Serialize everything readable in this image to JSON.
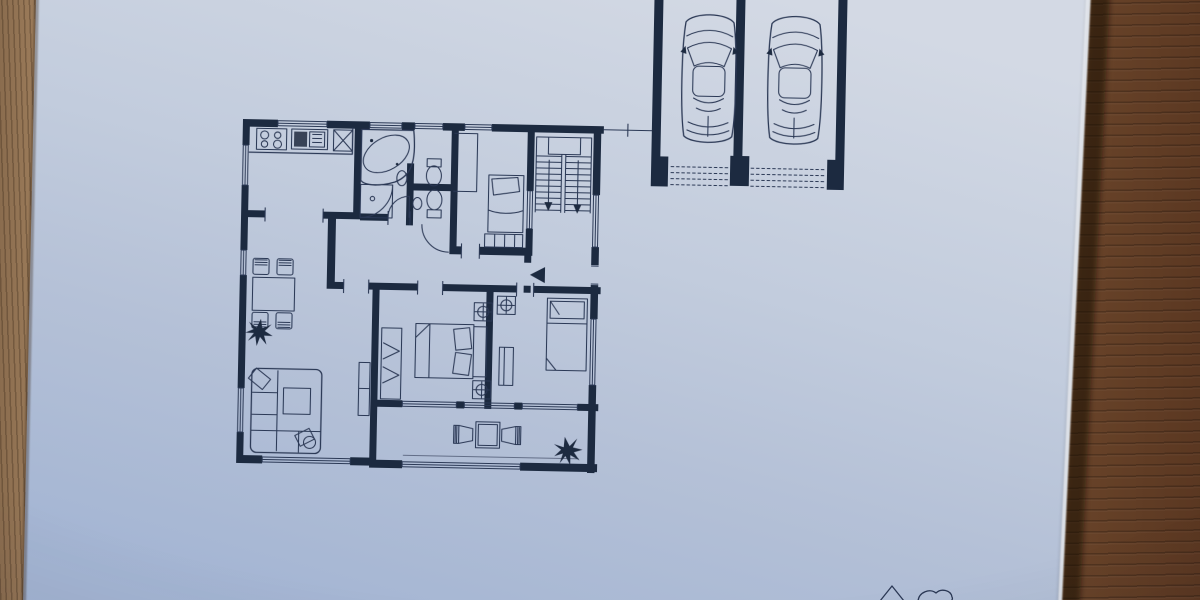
{
  "scene": {
    "description": "Photograph of a blueprint-style architectural floor plan drawn in dark ink on light blue paper, lying slightly tilted on a two-tone wooden table",
    "paper_tilt_deg": 1.15,
    "rooms": [
      "kitchen",
      "bathroom",
      "wc",
      "small-bedroom",
      "stairwell",
      "hall",
      "entrance-corridor",
      "living-dining-room",
      "master-bedroom",
      "second-bedroom",
      "balcony-terrace",
      "double-garage"
    ],
    "fixtures": [
      "stove-4-burner",
      "kitchen-sink",
      "kitchen-cabinet",
      "corner-bathtub",
      "shower",
      "wash-basin",
      "toilet",
      "dining-table",
      "dining-chair",
      "potted-plant",
      "corner-sofa",
      "coffee-table",
      "living-cabinet",
      "wardrobe",
      "double-bed",
      "nightstand-with-lamp",
      "single-bed",
      "desk",
      "closet",
      "balcony-table",
      "balcony-chair",
      "u-shaped-staircase",
      "entrance-direction-arrow",
      "car-top-view",
      "garage-door-hatching"
    ],
    "counts": {
      "garage_bays": 2,
      "cars": 2,
      "stair_flights": 2,
      "dining_chairs": 4,
      "balcony_chairs": 2,
      "plants": 2,
      "beds": 3,
      "toilets": 2,
      "nightstands_with_lamp": 3
    }
  },
  "colors": {
    "paper_light": "#d3d9e4",
    "paper_mid": "#bcc8db",
    "paper_deep": "#a4b5d3",
    "ink": "#1e2941",
    "line": "#2c3854",
    "wood_left_a": "#8a6c4e",
    "wood_left_b": "#a3825f",
    "wood_right_a": "#3f2517",
    "wood_right_b": "#5a3721",
    "wood_right_c": "#6e482c",
    "edge_shadow": "#140b06",
    "edge_highlight": "#e9edf3"
  }
}
